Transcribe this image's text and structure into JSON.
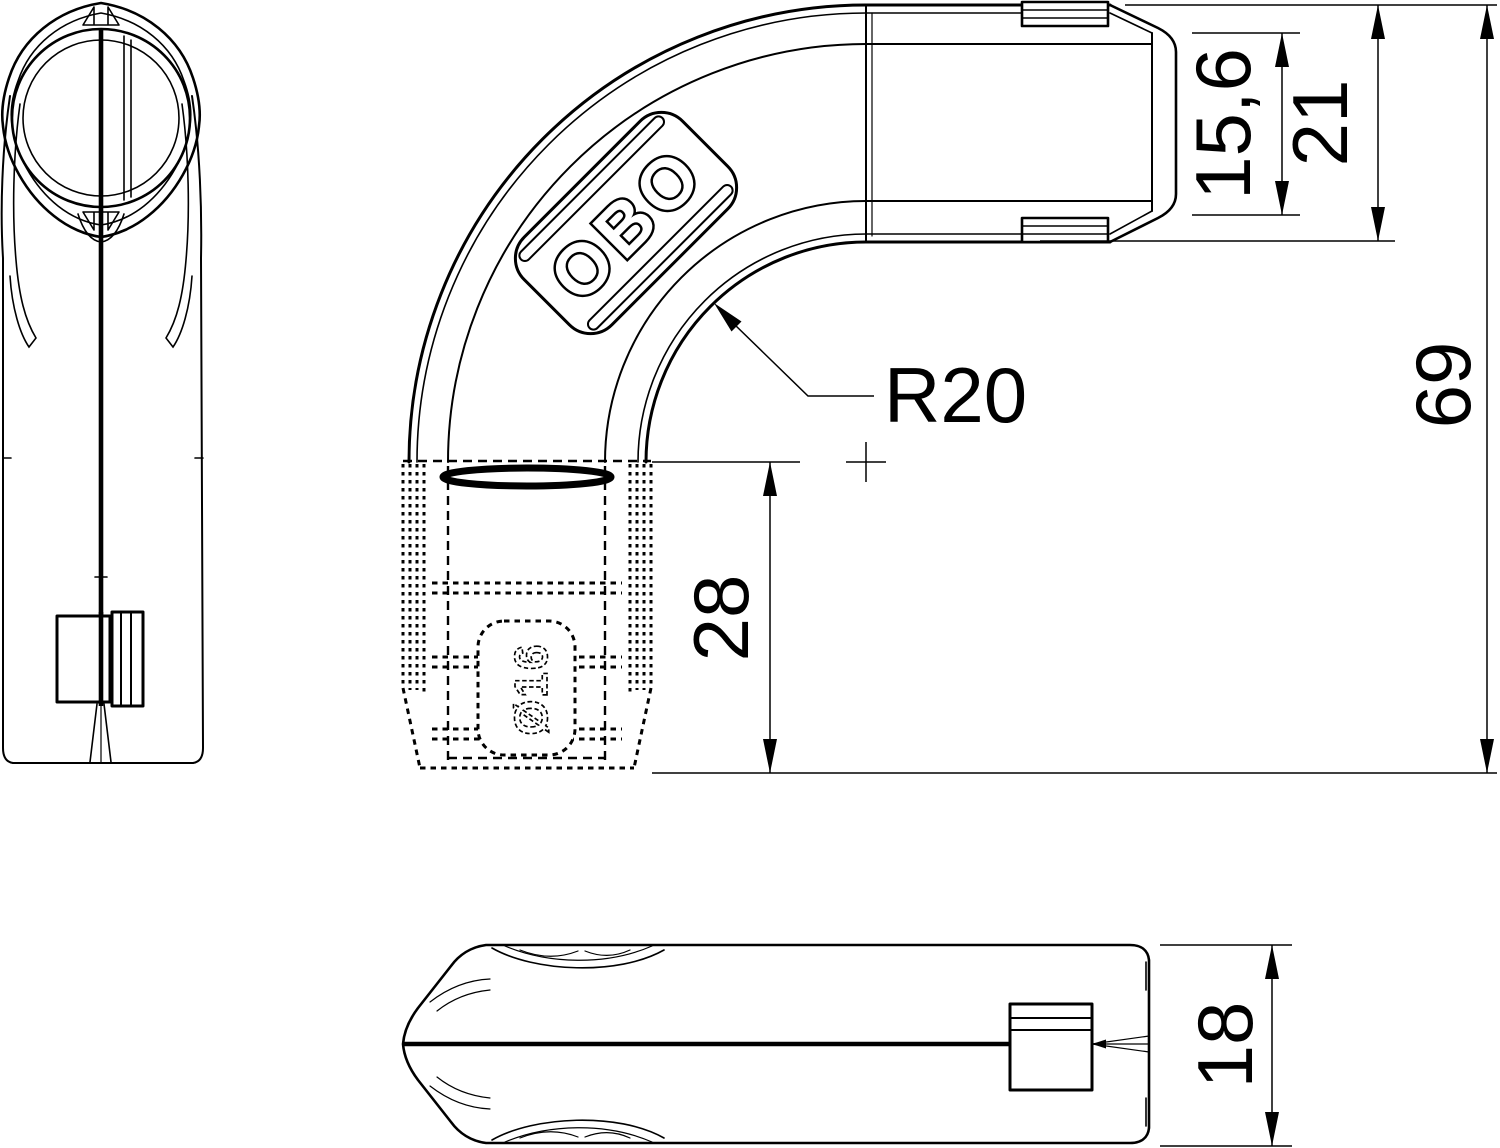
{
  "drawing": {
    "type": "technical-drawing",
    "product": "pipe bend fitting",
    "background_color": "#ffffff",
    "line_color": "#000000",
    "logo_text": "OBO",
    "part_marking": "Ø16",
    "dimensions": {
      "bend_radius": "R20",
      "socket_depth": "28",
      "end_inner_height": "15,6",
      "end_outer_height": "21",
      "total_height": "69",
      "body_width": "18"
    },
    "views": {
      "end_view": "left side end view",
      "main_view": "front view of 90 degree bend",
      "top_view": "bottom horizontal view"
    }
  }
}
